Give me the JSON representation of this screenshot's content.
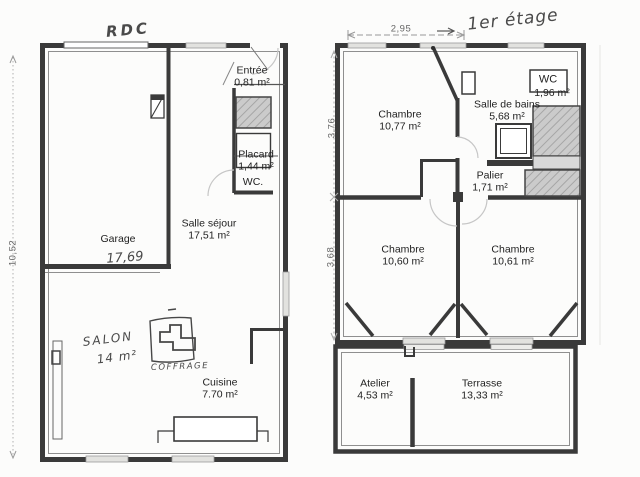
{
  "document": {
    "type": "scanned floor plan",
    "palette": {
      "paper": "#fcfcfb",
      "ink": "#3a3a3a",
      "stair_hatch": "#cbcbcb",
      "window_light": "#e2e2df",
      "faint_arc": "#c6c6c6",
      "handwriting": "#4a4a4a"
    }
  },
  "floors": {
    "rdc": {
      "title": "RDC",
      "dim_left": "10,52",
      "rooms": {
        "garage": {
          "name": "Garage",
          "area_hand": "17,69"
        },
        "entree": {
          "name": "Entrée",
          "area": "0,81 m²"
        },
        "placard": {
          "name": "Placard",
          "area": "1,44 m²"
        },
        "wc": {
          "name": "WC."
        },
        "sejour": {
          "name": "Salle séjour",
          "area": "17,51 m²"
        },
        "salon": {
          "name": "SALON",
          "area": "14 m²"
        },
        "coffrage": {
          "name": "COFFRAGE"
        },
        "cuisine": {
          "name": "Cuisine",
          "area": "7.70 m²"
        }
      }
    },
    "etage": {
      "title": "1er étage",
      "dim_top": "2,95",
      "dim_left_upper": "3,76",
      "dim_left_lower": "3,68",
      "rooms": {
        "chambre1": {
          "name": "Chambre",
          "area": "10,77 m²"
        },
        "sdb": {
          "name": "Salle de bains",
          "area": "5,68 m²"
        },
        "wc": {
          "name": "WC",
          "area": "1,96 m²"
        },
        "palier": {
          "name": "Palier",
          "area": "1,71 m²"
        },
        "chambre2": {
          "name": "Chambre",
          "area": "10,60 m²"
        },
        "chambre3": {
          "name": "Chambre",
          "area": "10,61 m²"
        },
        "atelier": {
          "name": "Atelier",
          "area": "4,53 m²"
        },
        "terrasse": {
          "name": "Terrasse",
          "area": "13,33 m²"
        }
      }
    }
  }
}
